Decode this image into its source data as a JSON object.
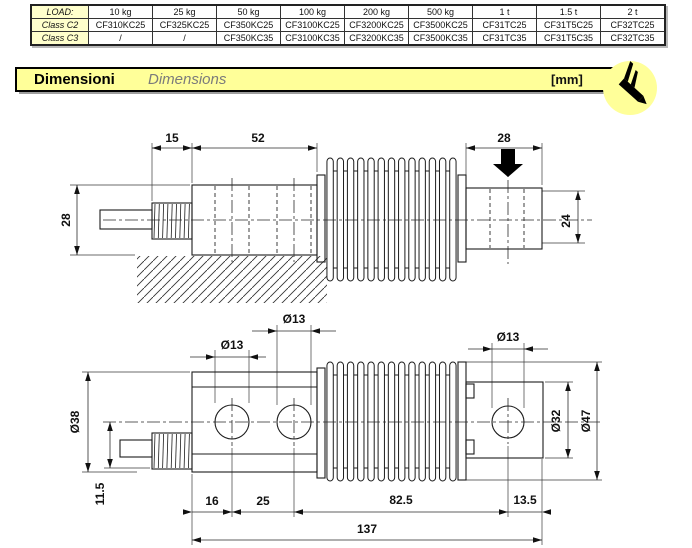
{
  "table": {
    "rows": [
      {
        "label": "LOAD:",
        "cells": [
          "10 kg",
          "25 kg",
          "50 kg",
          "100 kg",
          "200 kg",
          "500 kg",
          "1 t",
          "1.5 t",
          "2 t"
        ]
      },
      {
        "label": "Class C2",
        "cells": [
          "CF310KC25",
          "CF325KC25",
          "CF350KC25",
          "CF3100KC25",
          "CF3200KC25",
          "CF3500KC25",
          "CF31TC25",
          "CF31T5C25",
          "CF32TC25"
        ]
      },
      {
        "label": "Class C3",
        "cells": [
          "/",
          "/",
          "CF350KC35",
          "CF3100KC35",
          "CF3200KC35",
          "CF3500KC35",
          "CF31TC35",
          "CF31T5C35",
          "CF32TC35"
        ]
      }
    ]
  },
  "banner": {
    "title_it": "Dimensioni",
    "title_en": "Dimensions",
    "unit": "[mm]",
    "icon": "caliper-icon"
  },
  "colors": {
    "banner_yellow": "#FFFF99",
    "table_label_yellow": "#FFFFCC",
    "line": "#1c1c1c",
    "shadow_gray": "#9e9e9e"
  },
  "drawing": {
    "side": {
      "gland": "15",
      "beam": "52",
      "end": "28",
      "height": "28",
      "end_height": "24"
    },
    "plan": {
      "hole1": "Ø13",
      "hole2": "Ø13",
      "end_hole": "Ø13",
      "width": "Ø38",
      "boss": "Ø32",
      "flange": "Ø47",
      "cable": "11.5",
      "s16": "16",
      "s25": "25",
      "s82": "82.5",
      "s13": "13.5",
      "total": "137"
    }
  }
}
